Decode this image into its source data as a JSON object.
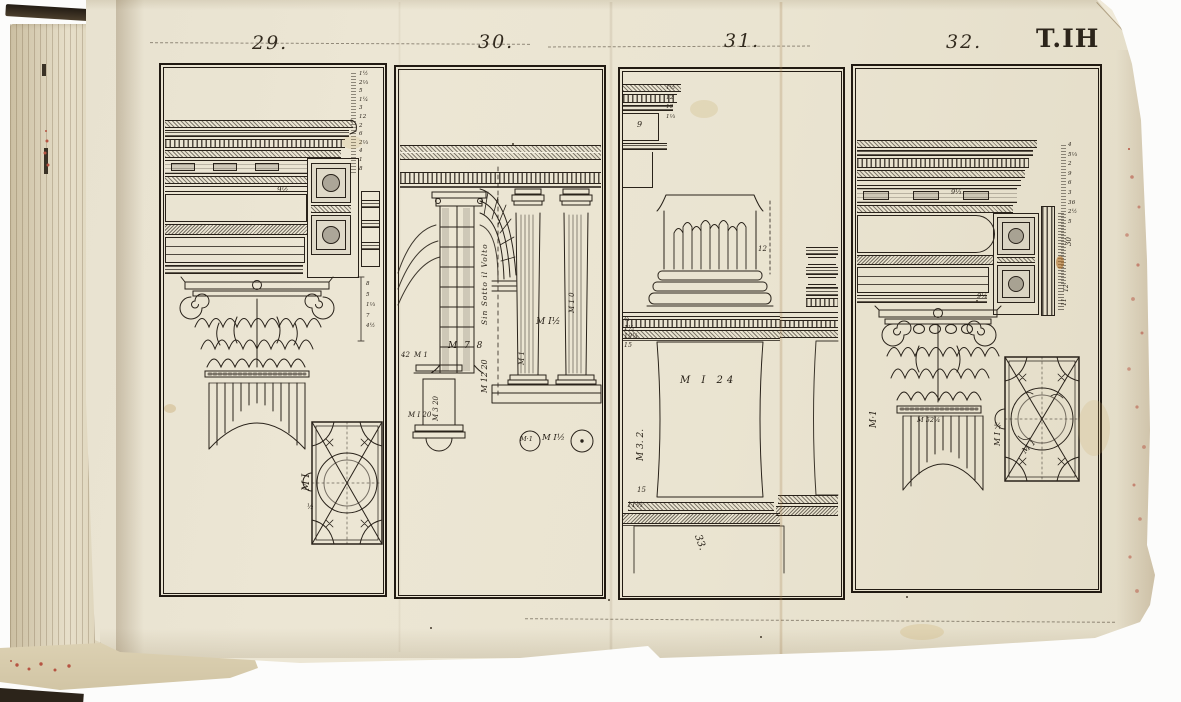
{
  "page": {
    "plate_ref": "T.IH",
    "panel_numbers": [
      "29.",
      "30.",
      "31.",
      "32."
    ],
    "colors": {
      "paper": "#eae3d0",
      "ink": "#29221a",
      "speckle": "#b65442"
    }
  },
  "p29": {
    "number": "29.",
    "margin_numbers": [
      "1½",
      "2⅓",
      "5",
      "1¼",
      "3",
      "12",
      "2",
      "6",
      "2⅓",
      "4",
      "1",
      "8"
    ],
    "bracket_numbers": [
      "8",
      "5",
      "1⅓",
      "7",
      "4½"
    ],
    "modillion_number": "9½",
    "plan_label": "M I",
    "plan_fraction": "½"
  },
  "p30": {
    "number": "30.",
    "arch_note": "Sin Sotto il Volto",
    "dim_vertical": "M 12 20",
    "dim_horizontal": "M 7 8",
    "pier_number": "42",
    "pier_module": "M 1",
    "column_left_module": "M 1",
    "column_right_module": "M 1 0",
    "intercolumn_module": "M I½",
    "pedestal_vertical": "M 3 20",
    "pedestal_base": "M I 20",
    "circle_left_label": "M·1",
    "circle_mid_label": "M I½"
  },
  "p31": {
    "number": "31.",
    "frieze_number": "9",
    "margin_numbers": [
      "1½",
      "12",
      "19",
      "1⅓"
    ],
    "base_number": "12",
    "cap_numbers": [
      "¾",
      "1⅓",
      "19¼",
      "15"
    ],
    "die_label": "M I 24",
    "die_vertical": "M 3. 2.",
    "lower_left_top": "15",
    "lower_left_bottom": "11⅓",
    "plinth_number": "33."
  },
  "p32": {
    "number": "32.",
    "margin_numbers": [
      "4",
      "5⅓",
      "2",
      "9",
      "6",
      "3",
      "36",
      "2½",
      "5"
    ],
    "soffit_number_upper": "9⅓",
    "soffit_number_lower": "9¼",
    "rotated_30": "30",
    "rotated_12": "12",
    "rotated_11": "11",
    "capital_module": "M·1",
    "shaft_number": "M 52¼",
    "plan_vertical": "M I ½",
    "plan_diagonal": "M 1"
  }
}
